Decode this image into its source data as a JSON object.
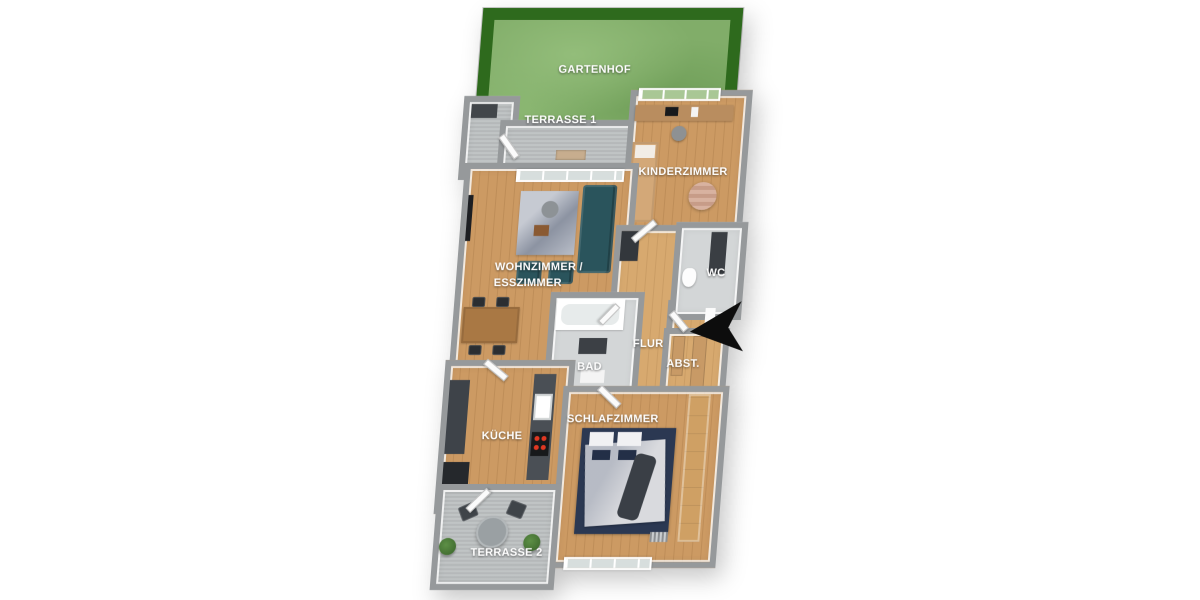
{
  "plan": {
    "rooms": {
      "gartenhof": {
        "label": "GARTENHOF"
      },
      "terrasse_1": {
        "label": "TERRASSE 1"
      },
      "kinderzimmer": {
        "label": "KINDERZIMMER"
      },
      "wohnzimmer_esszimmer": {
        "label_line1": "WOHNZIMMER /",
        "label_line2": "ESSZIMMER"
      },
      "wc": {
        "label": "WC"
      },
      "flur": {
        "label": "FLUR"
      },
      "bad": {
        "label": "BAD"
      },
      "abstellraum": {
        "label": "ABST."
      },
      "kueche": {
        "label": "KÜCHE"
      },
      "schlafzimmer": {
        "label": "SCHLAFZIMMER"
      },
      "terrasse_2": {
        "label": "TERRASSE 2"
      }
    },
    "icons": {
      "entrance_arrow": "◀"
    },
    "colors": {
      "background": "#ffffff",
      "hedge_green": "#2e6a1d",
      "lawn_green": "#81ad69",
      "wall_gray": "#96999b",
      "wood_floor": "#cc9a63",
      "wood_floor_light": "#d7a96f",
      "concrete_gray": "#bcc0c1",
      "tile_gray": "#d3d6d7",
      "sofa_teal": "#2a545c",
      "bed_navy": "#2b3852",
      "furniture_tan": "#d3a878",
      "entrance_arrow_black": "#0d0d0d"
    }
  }
}
